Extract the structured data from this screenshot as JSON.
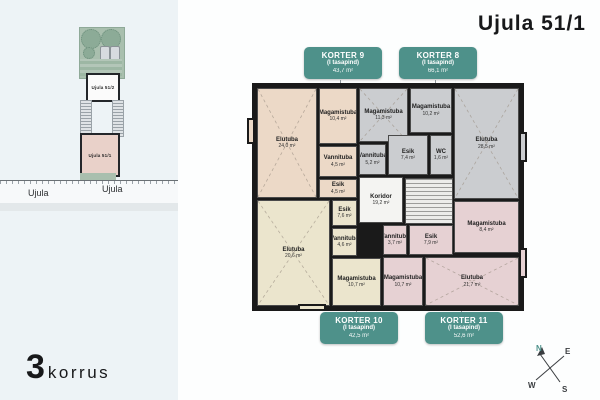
{
  "title": "Ujula 51/1",
  "floor": {
    "number": "3",
    "word": "korrus"
  },
  "site_plan": {
    "building_upper_label": "Ujula 51/2",
    "building_lower_label": "Ujula 51/1",
    "street_label_1": "Ujula",
    "street_label_2": "Ujula"
  },
  "compass": {
    "n": "N",
    "e": "E",
    "s": "S",
    "w": "W"
  },
  "accent_color": "#4e918a",
  "apartments": [
    {
      "id": "korter-9",
      "name": "KORTER 9",
      "subtitle": "(I tasapind)",
      "area": "43,7 m²",
      "color": "#ecd9c7"
    },
    {
      "id": "korter-8",
      "name": "KORTER 8",
      "subtitle": "(I tasapind)",
      "area": "66,1 m²",
      "color": "#cbcdd0"
    },
    {
      "id": "korter-10",
      "name": "KORTER 10",
      "subtitle": "(I tasapind)",
      "area": "42,5 m²",
      "color": "#ebe5cd"
    },
    {
      "id": "korter-11",
      "name": "KORTER 11",
      "subtitle": "(I tasapind)",
      "area": "52,6 m²",
      "color": "#e6d1d3"
    }
  ],
  "rooms": [
    {
      "apartment": "korter-9",
      "name": "Elutuba",
      "area": "24,0 m²",
      "x": 2,
      "y": 2,
      "w": 60,
      "h": 110,
      "diag": true
    },
    {
      "apartment": "korter-9",
      "name": "Magamistuba",
      "area": "10,4 m²",
      "x": 64,
      "y": 2,
      "w": 38,
      "h": 56
    },
    {
      "apartment": "korter-9",
      "name": "Vannituba",
      "area": "4,5 m²",
      "x": 64,
      "y": 60,
      "w": 38,
      "h": 31
    },
    {
      "apartment": "korter-9",
      "name": "Esik",
      "area": "4,5 m²",
      "x": 64,
      "y": 93,
      "w": 38,
      "h": 19
    },
    {
      "apartment": "korter-8",
      "name": "Magamistuba",
      "area": "11,3 m²",
      "x": 104,
      "y": 2,
      "w": 49,
      "h": 54,
      "diag": true
    },
    {
      "apartment": "korter-8",
      "name": "Magamistuba",
      "area": "10,2 m²",
      "x": 155,
      "y": 2,
      "w": 42,
      "h": 45
    },
    {
      "apartment": "korter-8",
      "name": "WC",
      "area": "1,6 m²",
      "x": 175,
      "y": 49,
      "w": 22,
      "h": 40
    },
    {
      "apartment": "korter-8",
      "name": "Vannituba",
      "area": "5,2 m²",
      "x": 104,
      "y": 58,
      "w": 27,
      "h": 31
    },
    {
      "apartment": "korter-8",
      "name": "Esik",
      "area": "7,4 m²",
      "x": 133,
      "y": 49,
      "w": 40,
      "h": 40
    },
    {
      "apartment": "korter-8",
      "name": "Elutuba",
      "area": "28,5 m²",
      "x": 199,
      "y": 2,
      "w": 65,
      "h": 111,
      "diag": true
    },
    {
      "apartment": "common",
      "name": "Koridor",
      "area": "19,2 m²",
      "x": 104,
      "y": 91,
      "w": 44,
      "h": 46,
      "color": "#f4f4f2"
    },
    {
      "apartment": "korter-10",
      "name": "Elutuba",
      "area": "20,6 m²",
      "x": 2,
      "y": 114,
      "w": 73,
      "h": 106,
      "diag": true
    },
    {
      "apartment": "korter-10",
      "name": "Esik",
      "area": "7,6 m²",
      "x": 77,
      "y": 114,
      "w": 25,
      "h": 26
    },
    {
      "apartment": "korter-10",
      "name": "Vannituba",
      "area": "4,6 m²",
      "x": 77,
      "y": 142,
      "w": 25,
      "h": 28
    },
    {
      "apartment": "korter-10",
      "name": "Magamistuba",
      "area": "10,7 m²",
      "x": 77,
      "y": 172,
      "w": 49,
      "h": 48
    },
    {
      "apartment": "korter-11",
      "name": "Vannituba",
      "area": "3,7 m²",
      "x": 128,
      "y": 139,
      "w": 24,
      "h": 30
    },
    {
      "apartment": "korter-11",
      "name": "Esik",
      "area": "7,9 m²",
      "x": 154,
      "y": 139,
      "w": 44,
      "h": 30
    },
    {
      "apartment": "korter-11",
      "name": "Magamistuba",
      "area": "8,4 m²",
      "x": 199,
      "y": 115,
      "w": 65,
      "h": 52
    },
    {
      "apartment": "korter-11",
      "name": "Magamistuba",
      "area": "10,7 m²",
      "x": 128,
      "y": 171,
      "w": 40,
      "h": 49
    },
    {
      "apartment": "korter-11",
      "name": "Elutuba",
      "area": "21,7 m²",
      "x": 170,
      "y": 171,
      "w": 94,
      "h": 49,
      "diag": true
    }
  ]
}
